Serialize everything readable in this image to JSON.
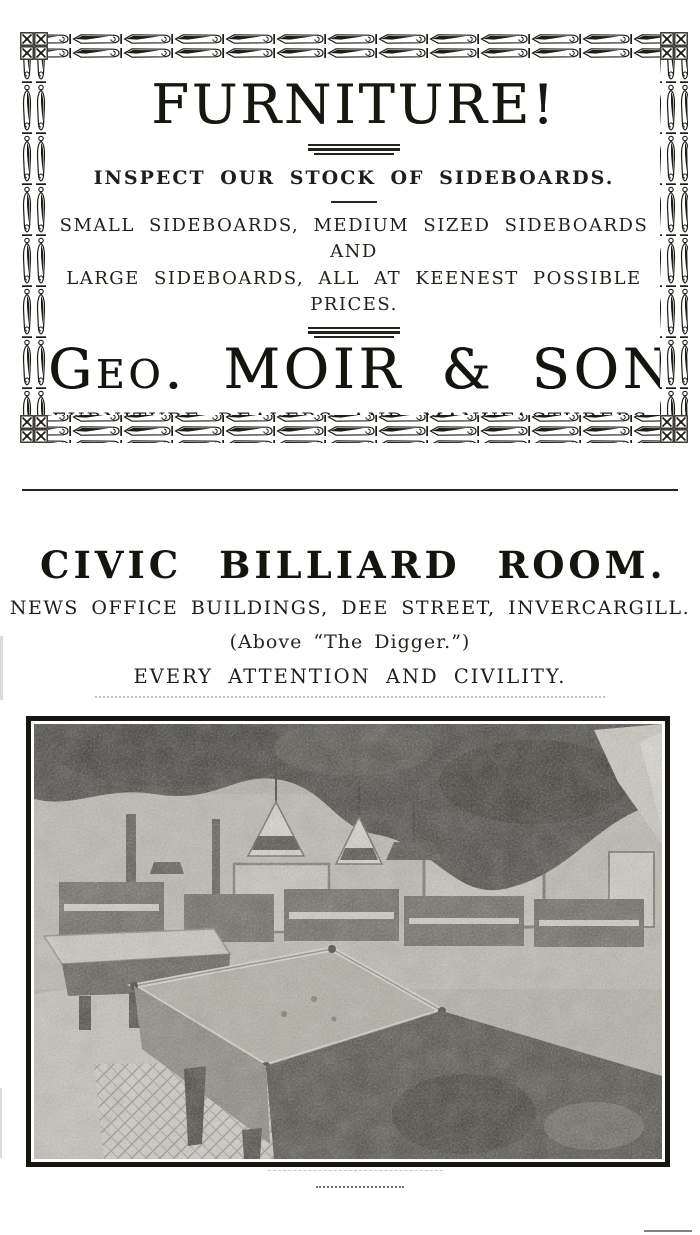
{
  "page": {
    "paper_color": "#ffffff",
    "ink_color": "#1d1b15"
  },
  "furniture_ad": {
    "headline": "FURNITURE!",
    "subheadline": "INSPECT OUR STOCK OF SIDEBOARDS.",
    "body_lines": [
      "SMALL SIDEBOARDS, MEDIUM SIZED SIDEBOARDS AND",
      "LARGE SIDEBOARDS, ALL AT KEENEST POSSIBLE PRICES."
    ],
    "company_name": "Geo. MOIR & SON,",
    "company_descriptor": "FURNITURE DEALERS AND MANUFACTURERS,",
    "street_address": "72 and 74 TAY STREET.",
    "location_hint": "(Next Price and Bulleid.)"
  },
  "billiard_ad": {
    "title": "CIVIC BILLIARD ROOM.",
    "address": "NEWS OFFICE BUILDINGS, DEE STREET, INVERCARGILL.",
    "location_note": "(Above “The Digger.”)",
    "tagline": "EVERY ATTENTION AND CIVILITY."
  }
}
